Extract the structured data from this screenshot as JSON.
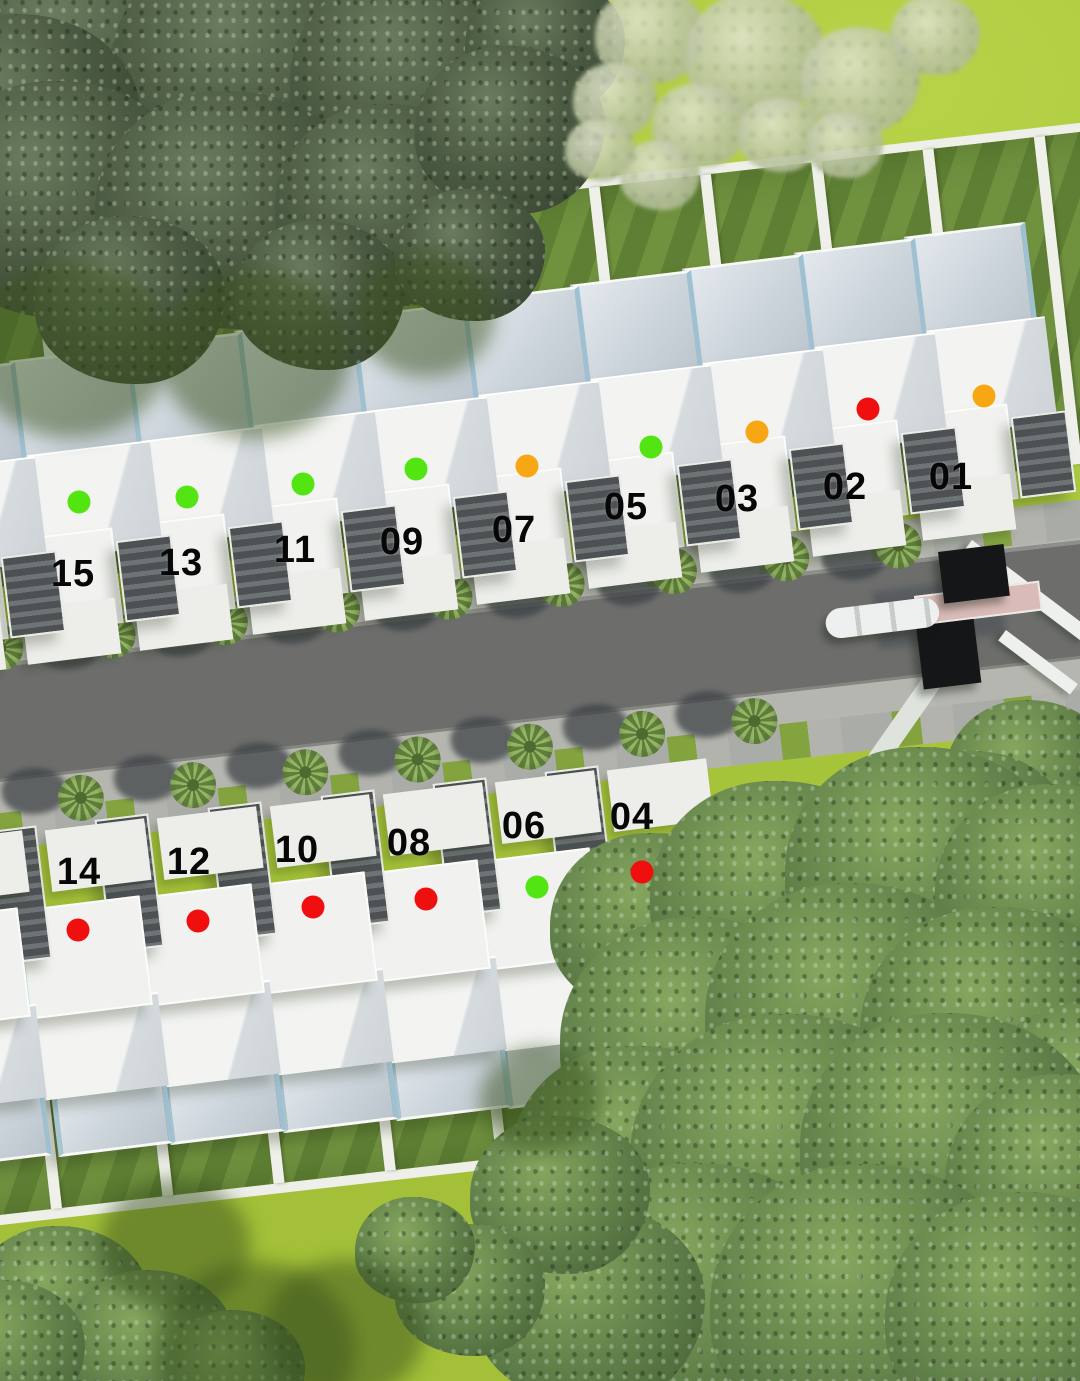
{
  "scene": {
    "title": "residential-site-plan-aerial",
    "width": 1080,
    "height": 1381,
    "status_colors": {
      "green": "#52e512",
      "orange": "#f6a713",
      "red": "#ef0f0f"
    },
    "palette": {
      "grass": "#abc93e",
      "lawn_dark": "#5f8034",
      "road": "#6d6e6c",
      "sidewalk": "#b5b6b0",
      "house_white": "#f1f2ef",
      "roof_blue": "#ccd4db",
      "tree_dark": "#4b5a42",
      "tree_mid": "#61814a",
      "gate_dark": "#141618",
      "gate_pink": "#d9bbb7"
    }
  },
  "units": [
    {
      "number": "01",
      "status": "orange",
      "row": "north",
      "house": {
        "x": 900,
        "y": 228
      },
      "dot": {
        "x": 984,
        "y": 396
      },
      "label": {
        "x": 951,
        "y": 477
      }
    },
    {
      "number": "02",
      "status": "red",
      "row": "north",
      "house": {
        "x": 790,
        "y": 244
      },
      "dot": {
        "x": 868,
        "y": 409
      },
      "label": {
        "x": 845,
        "y": 487
      }
    },
    {
      "number": "03",
      "status": "orange",
      "row": "north",
      "house": {
        "x": 678,
        "y": 260
      },
      "dot": {
        "x": 757,
        "y": 432
      },
      "label": {
        "x": 737,
        "y": 499
      }
    },
    {
      "number": "05",
      "status": "green",
      "row": "north",
      "house": {
        "x": 566,
        "y": 276
      },
      "dot": {
        "x": 651,
        "y": 447
      },
      "label": {
        "x": 626,
        "y": 507
      }
    },
    {
      "number": "07",
      "status": "orange",
      "row": "north",
      "house": {
        "x": 454,
        "y": 292
      },
      "dot": {
        "x": 527,
        "y": 466
      },
      "label": {
        "x": 514,
        "y": 530
      }
    },
    {
      "number": "09",
      "status": "green",
      "row": "north",
      "house": {
        "x": 342,
        "y": 308
      },
      "dot": {
        "x": 416,
        "y": 469
      },
      "label": {
        "x": 402,
        "y": 542
      }
    },
    {
      "number": "11",
      "status": "green",
      "row": "north",
      "house": {
        "x": 230,
        "y": 322
      },
      "dot": {
        "x": 303,
        "y": 484
      },
      "label": {
        "x": 295,
        "y": 550
      }
    },
    {
      "number": "13",
      "status": "green",
      "row": "north",
      "house": {
        "x": 117,
        "y": 338
      },
      "dot": {
        "x": 187,
        "y": 497
      },
      "label": {
        "x": 181,
        "y": 563
      }
    },
    {
      "number": "15",
      "status": "green",
      "row": "north",
      "house": {
        "x": 5,
        "y": 352
      },
      "dot": {
        "x": 79,
        "y": 502
      },
      "label": {
        "x": 73,
        "y": 574
      }
    },
    {
      "number": "04",
      "status": "red",
      "row": "south",
      "house": {
        "x": 570,
        "y": 760
      },
      "dot": {
        "x": 642,
        "y": 872
      },
      "label": {
        "x": 632,
        "y": 817
      }
    },
    {
      "number": "06",
      "status": "green",
      "row": "south",
      "house": {
        "x": 458,
        "y": 772
      },
      "dot": {
        "x": 537,
        "y": 887
      },
      "label": {
        "x": 524,
        "y": 826
      }
    },
    {
      "number": "08",
      "status": "red",
      "row": "south",
      "house": {
        "x": 346,
        "y": 784
      },
      "dot": {
        "x": 426,
        "y": 899
      },
      "label": {
        "x": 409,
        "y": 843
      }
    },
    {
      "number": "10",
      "status": "red",
      "row": "south",
      "house": {
        "x": 233,
        "y": 796
      },
      "dot": {
        "x": 313,
        "y": 907
      },
      "label": {
        "x": 297,
        "y": 850
      }
    },
    {
      "number": "12",
      "status": "red",
      "row": "south",
      "house": {
        "x": 120,
        "y": 808
      },
      "dot": {
        "x": 198,
        "y": 921
      },
      "label": {
        "x": 189,
        "y": 862
      }
    },
    {
      "number": "14",
      "status": "red",
      "row": "south",
      "house": {
        "x": 8,
        "y": 820
      },
      "dot": {
        "x": 78,
        "y": 930
      },
      "label": {
        "x": 79,
        "y": 872
      }
    }
  ],
  "decor": {
    "extra_houses": [
      {
        "row": "north",
        "x": -110,
        "y": 368
      },
      {
        "row": "south",
        "x": -114,
        "y": 832
      }
    ],
    "fence": {
      "count": 13,
      "step": 112,
      "post_width": 11
    },
    "palms": {
      "north": {
        "y": 2,
        "xs": [
          55,
          168,
          281,
          394,
          507,
          620,
          733,
          846,
          959
        ]
      },
      "south": {
        "y": 160,
        "xs": [
          118,
          231,
          344,
          457,
          570,
          683,
          796
        ]
      }
    },
    "foliage": [
      {
        "tone": "dark",
        "x": 90,
        "y": 60,
        "r": 150
      },
      {
        "tone": "dark",
        "x": 260,
        "y": 70,
        "r": 150
      },
      {
        "tone": "dark",
        "x": 420,
        "y": 80,
        "r": 130
      },
      {
        "tone": "dark",
        "x": 545,
        "y": 45,
        "r": 80
      },
      {
        "tone": "dark",
        "x": 20,
        "y": 120,
        "r": 120
      },
      {
        "tone": "dark",
        "x": 60,
        "y": 200,
        "r": 135
      },
      {
        "tone": "dark",
        "x": 230,
        "y": 210,
        "r": 135
      },
      {
        "tone": "dark",
        "x": 390,
        "y": 205,
        "r": 115
      },
      {
        "tone": "dark",
        "x": 510,
        "y": 130,
        "r": 95
      },
      {
        "tone": "dark",
        "x": 130,
        "y": 300,
        "r": 95
      },
      {
        "tone": "dark",
        "x": 320,
        "y": 295,
        "r": 85
      },
      {
        "tone": "dark",
        "x": 470,
        "y": 255,
        "r": 75
      },
      {
        "tone": "shadow",
        "x": 70,
        "y": 350,
        "r": 100
      },
      {
        "tone": "shadow",
        "x": 255,
        "y": 355,
        "r": 95
      },
      {
        "tone": "shadow",
        "x": 425,
        "y": 315,
        "r": 70
      },
      {
        "tone": "light",
        "x": 650,
        "y": 35,
        "r": 55
      },
      {
        "tone": "light",
        "x": 755,
        "y": 55,
        "r": 70
      },
      {
        "tone": "light",
        "x": 860,
        "y": 80,
        "r": 60
      },
      {
        "tone": "light",
        "x": 935,
        "y": 35,
        "r": 45
      },
      {
        "tone": "light",
        "x": 615,
        "y": 100,
        "r": 42
      },
      {
        "tone": "light",
        "x": 700,
        "y": 125,
        "r": 48
      },
      {
        "tone": "light",
        "x": 780,
        "y": 135,
        "r": 42
      },
      {
        "tone": "light",
        "x": 845,
        "y": 145,
        "r": 38
      },
      {
        "tone": "light",
        "x": 660,
        "y": 175,
        "r": 40
      },
      {
        "tone": "light",
        "x": 600,
        "y": 150,
        "r": 35
      },
      {
        "tone": "mid",
        "x": 1030,
        "y": 775,
        "r": 85
      },
      {
        "tone": "mid",
        "x": 975,
        "y": 835,
        "r": 95
      },
      {
        "tone": "mid",
        "x": 655,
        "y": 925,
        "r": 105
      },
      {
        "tone": "mid",
        "x": 780,
        "y": 895,
        "r": 130
      },
      {
        "tone": "mid",
        "x": 925,
        "y": 870,
        "r": 140
      },
      {
        "tone": "mid",
        "x": 1055,
        "y": 890,
        "r": 120
      },
      {
        "tone": "mid",
        "x": 700,
        "y": 1040,
        "r": 140
      },
      {
        "tone": "mid",
        "x": 855,
        "y": 1015,
        "r": 150
      },
      {
        "tone": "mid",
        "x": 1000,
        "y": 1030,
        "r": 140
      },
      {
        "tone": "mid",
        "x": 1090,
        "y": 1100,
        "r": 110
      },
      {
        "tone": "mid",
        "x": 640,
        "y": 1160,
        "r": 130
      },
      {
        "tone": "mid",
        "x": 790,
        "y": 1155,
        "r": 160
      },
      {
        "tone": "mid",
        "x": 950,
        "y": 1145,
        "r": 150
      },
      {
        "tone": "mid",
        "x": 1065,
        "y": 1180,
        "r": 120
      },
      {
        "tone": "mid",
        "x": 700,
        "y": 1295,
        "r": 150
      },
      {
        "tone": "mid",
        "x": 870,
        "y": 1305,
        "r": 160
      },
      {
        "tone": "mid",
        "x": 1025,
        "y": 1315,
        "r": 140
      },
      {
        "tone": "mid",
        "x": 590,
        "y": 1305,
        "r": 115
      },
      {
        "tone": "mid",
        "x": 560,
        "y": 1195,
        "r": 90
      },
      {
        "tone": "mid",
        "x": 470,
        "y": 1290,
        "r": 75
      },
      {
        "tone": "mid",
        "x": 415,
        "y": 1250,
        "r": 60
      },
      {
        "tone": "mid",
        "x": 60,
        "y": 1305,
        "r": 90
      },
      {
        "tone": "mid",
        "x": 150,
        "y": 1345,
        "r": 85
      },
      {
        "tone": "mid",
        "x": 5,
        "y": 1350,
        "r": 80
      },
      {
        "tone": "mid",
        "x": 235,
        "y": 1372,
        "r": 70
      },
      {
        "tone": "shadow",
        "x": 255,
        "y": 1350,
        "r": 100
      },
      {
        "tone": "shadow",
        "x": 175,
        "y": 1245,
        "r": 75
      },
      {
        "tone": "shadow",
        "x": 345,
        "y": 1330,
        "r": 80
      },
      {
        "tone": "shadow",
        "x": 540,
        "y": 1100,
        "r": 60
      }
    ],
    "gate": {
      "shadow": {
        "x": 872,
        "y": 592,
        "w": 128,
        "h": 58,
        "rot": -7
      },
      "pillars": [
        {
          "x": 938,
          "y": 552,
          "w": 66,
          "h": 52,
          "rot": -7
        },
        {
          "x": 916,
          "y": 626,
          "w": 58,
          "h": 64,
          "rot": -7
        }
      ],
      "beam": {
        "x": 914,
        "y": 596,
        "w": 122,
        "h": 26,
        "rot": -7
      },
      "arm": {
        "x": 824,
        "y": 610,
        "w": 114,
        "h": 30,
        "rot": -7
      },
      "walls": [
        {
          "x": 972,
          "y": 540,
          "w": 150,
          "h": 15,
          "rot": 37
        },
        {
          "x": 1006,
          "y": 630,
          "w": 90,
          "h": 13,
          "rot": 37
        }
      ],
      "exit_path": {
        "x": 944,
        "y": 682,
        "w": 272,
        "h": 20,
        "rot": 125
      }
    }
  }
}
